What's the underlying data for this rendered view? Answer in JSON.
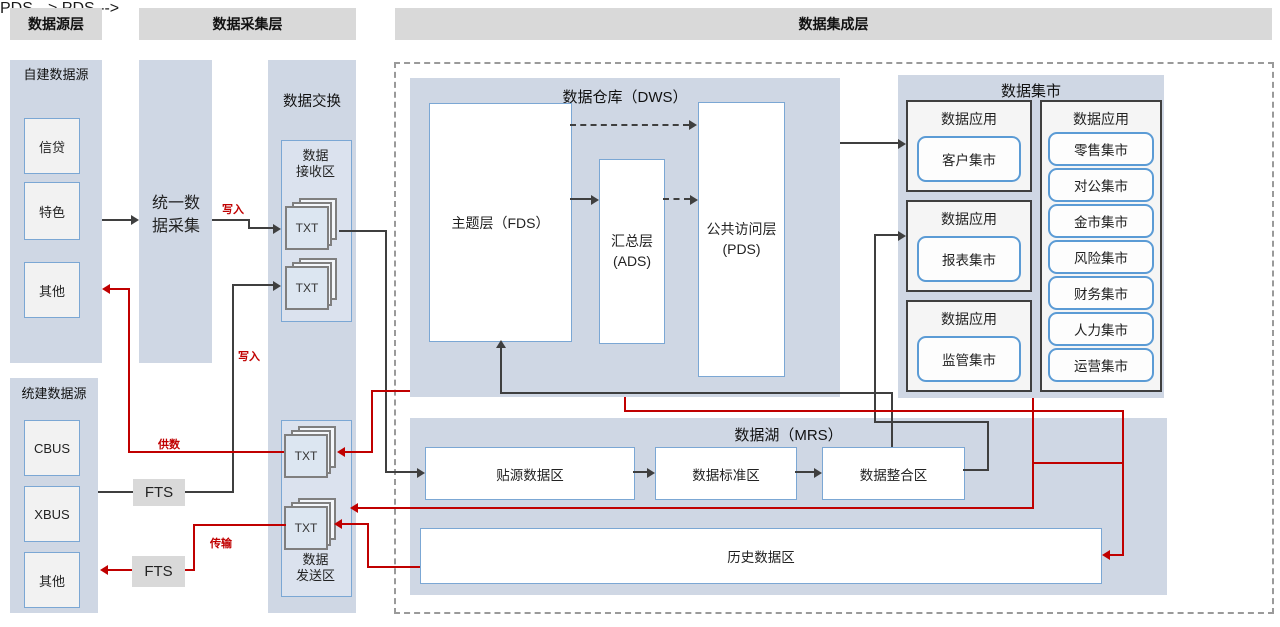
{
  "headers": {
    "source": "数据源层",
    "collection": "数据采集层",
    "integration": "数据集成层"
  },
  "source_layer": {
    "self_built": {
      "title": "自建数据源",
      "items": [
        "信贷",
        "特色",
        "其他"
      ]
    },
    "unified": {
      "title": "统建数据源",
      "items": [
        "CBUS",
        "XBUS",
        "其他"
      ]
    }
  },
  "collection": {
    "unified_collect": "统一数据采集",
    "fts_top": "FTS",
    "fts_bottom": "FTS",
    "exchange_title": "数据交换",
    "receive_zone": "数据\n接收区",
    "send_zone": "数据\n发送区",
    "txt": "TXT"
  },
  "dws": {
    "title": "数据仓库（DWS）",
    "fds": "主题层（FDS）",
    "ads": "汇总层\n(ADS)",
    "pds": "公共访问层\n(PDS)"
  },
  "mart": {
    "title": "数据集市",
    "app_label": "数据应用",
    "apps": [
      "客户集市",
      "报表集市",
      "监管集市"
    ],
    "list": [
      "零售集市",
      "对公集市",
      "金市集市",
      "风险集市",
      "财务集市",
      "人力集市",
      "运营集市"
    ]
  },
  "mrs": {
    "title": "数据湖（MRS）",
    "zones": [
      "贴源数据区",
      "数据标准区",
      "数据整合区"
    ],
    "history": "历史数据区"
  },
  "labels": {
    "write_top": "写入",
    "write_bottom": "写入",
    "supply": "供数",
    "transfer": "传输"
  },
  "colors": {
    "panel_blue": "#cfd7e4",
    "header_gray": "#d9d9d9",
    "box_border_blue": "#7ba7d4",
    "mart_border_blue": "#5b9bd5",
    "line_black": "#3f3f3f",
    "line_red": "#c00000"
  }
}
